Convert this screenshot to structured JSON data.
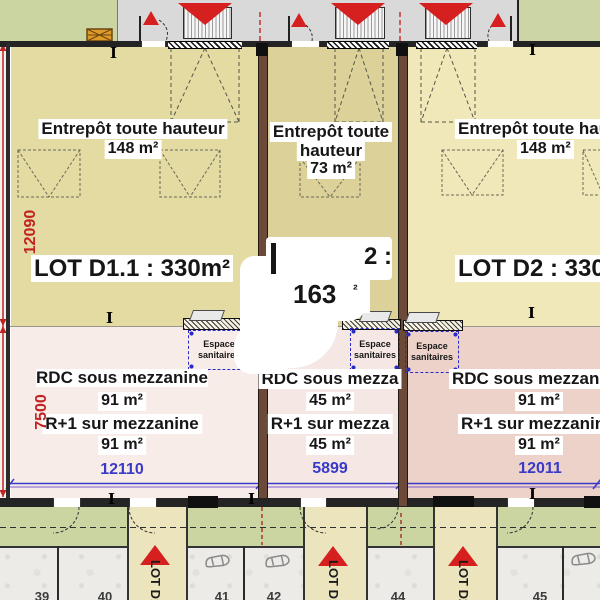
{
  "lots": [
    {
      "name": "LOT D1.1",
      "warehouse": {
        "label": "Entrepôt toute hauteur",
        "area": "148 m²"
      },
      "lot_label": "LOT D1.1 : 330m²",
      "mezzanine": {
        "rdc_label": "RDC sous mezzanine",
        "rdc_area": "91 m²",
        "r1_label": "R+1 sur mezzanine",
        "r1_area": "91 m²"
      },
      "width_dim": "12110"
    },
    {
      "name": "LOT D1.2",
      "warehouse": {
        "label_line1": "Entrepôt toute",
        "label_line2": "hauteur",
        "area": "73 m²"
      },
      "lot_label_visible": {
        "line1_right": "2 :",
        "line2_area": "163",
        "line2_sup": "²"
      },
      "mezzanine": {
        "rdc_label": "RDC sous mezza",
        "rdc_area": "45 m²",
        "r1_label": "R+1 sur mezza",
        "r1_area": "45 m²"
      },
      "width_dim": "5899"
    },
    {
      "name": "LOT D2",
      "warehouse": {
        "label": "Entrepôt toute hauteur",
        "area": "148 m²"
      },
      "lot_label": "LOT D2 : 330m²",
      "mezzanine": {
        "rdc_label": "RDC sous mezzanine",
        "rdc_area": "91 m²",
        "r1_label": "R+1 sur mezzanine",
        "r1_area": "91 m²"
      },
      "width_dim": "12011"
    }
  ],
  "sanitaires": {
    "line1": "Espace",
    "line2": "sanitaires"
  },
  "left_dims": {
    "warehouse_height": "12090",
    "mezzanine_height": "7500"
  },
  "walkway_labels": [
    "LOT D1.1",
    "LOT D1.2",
    "LOT D2"
  ],
  "parking_numbers": [
    "39",
    "40",
    "41",
    "42",
    "44",
    "45"
  ],
  "colors": {
    "arrow_red": "#d61f1f",
    "dim_red": "#c22222",
    "dim_blue": "#3a3ac8",
    "warehouse_left": "#e4dba2",
    "warehouse_mid": "#dcd198",
    "warehouse_right": "#f0e8b8",
    "mezzanine_left": "#f8ece9",
    "mezzanine_mid": "#f5e7e3",
    "mezzanine_right": "#ecd2c9",
    "grass_green": "#cbd5a2",
    "driveway_gray": "#d9d9d9",
    "walkway_beige": "#ece4bd",
    "wall_brown": "#6b4a3a"
  }
}
